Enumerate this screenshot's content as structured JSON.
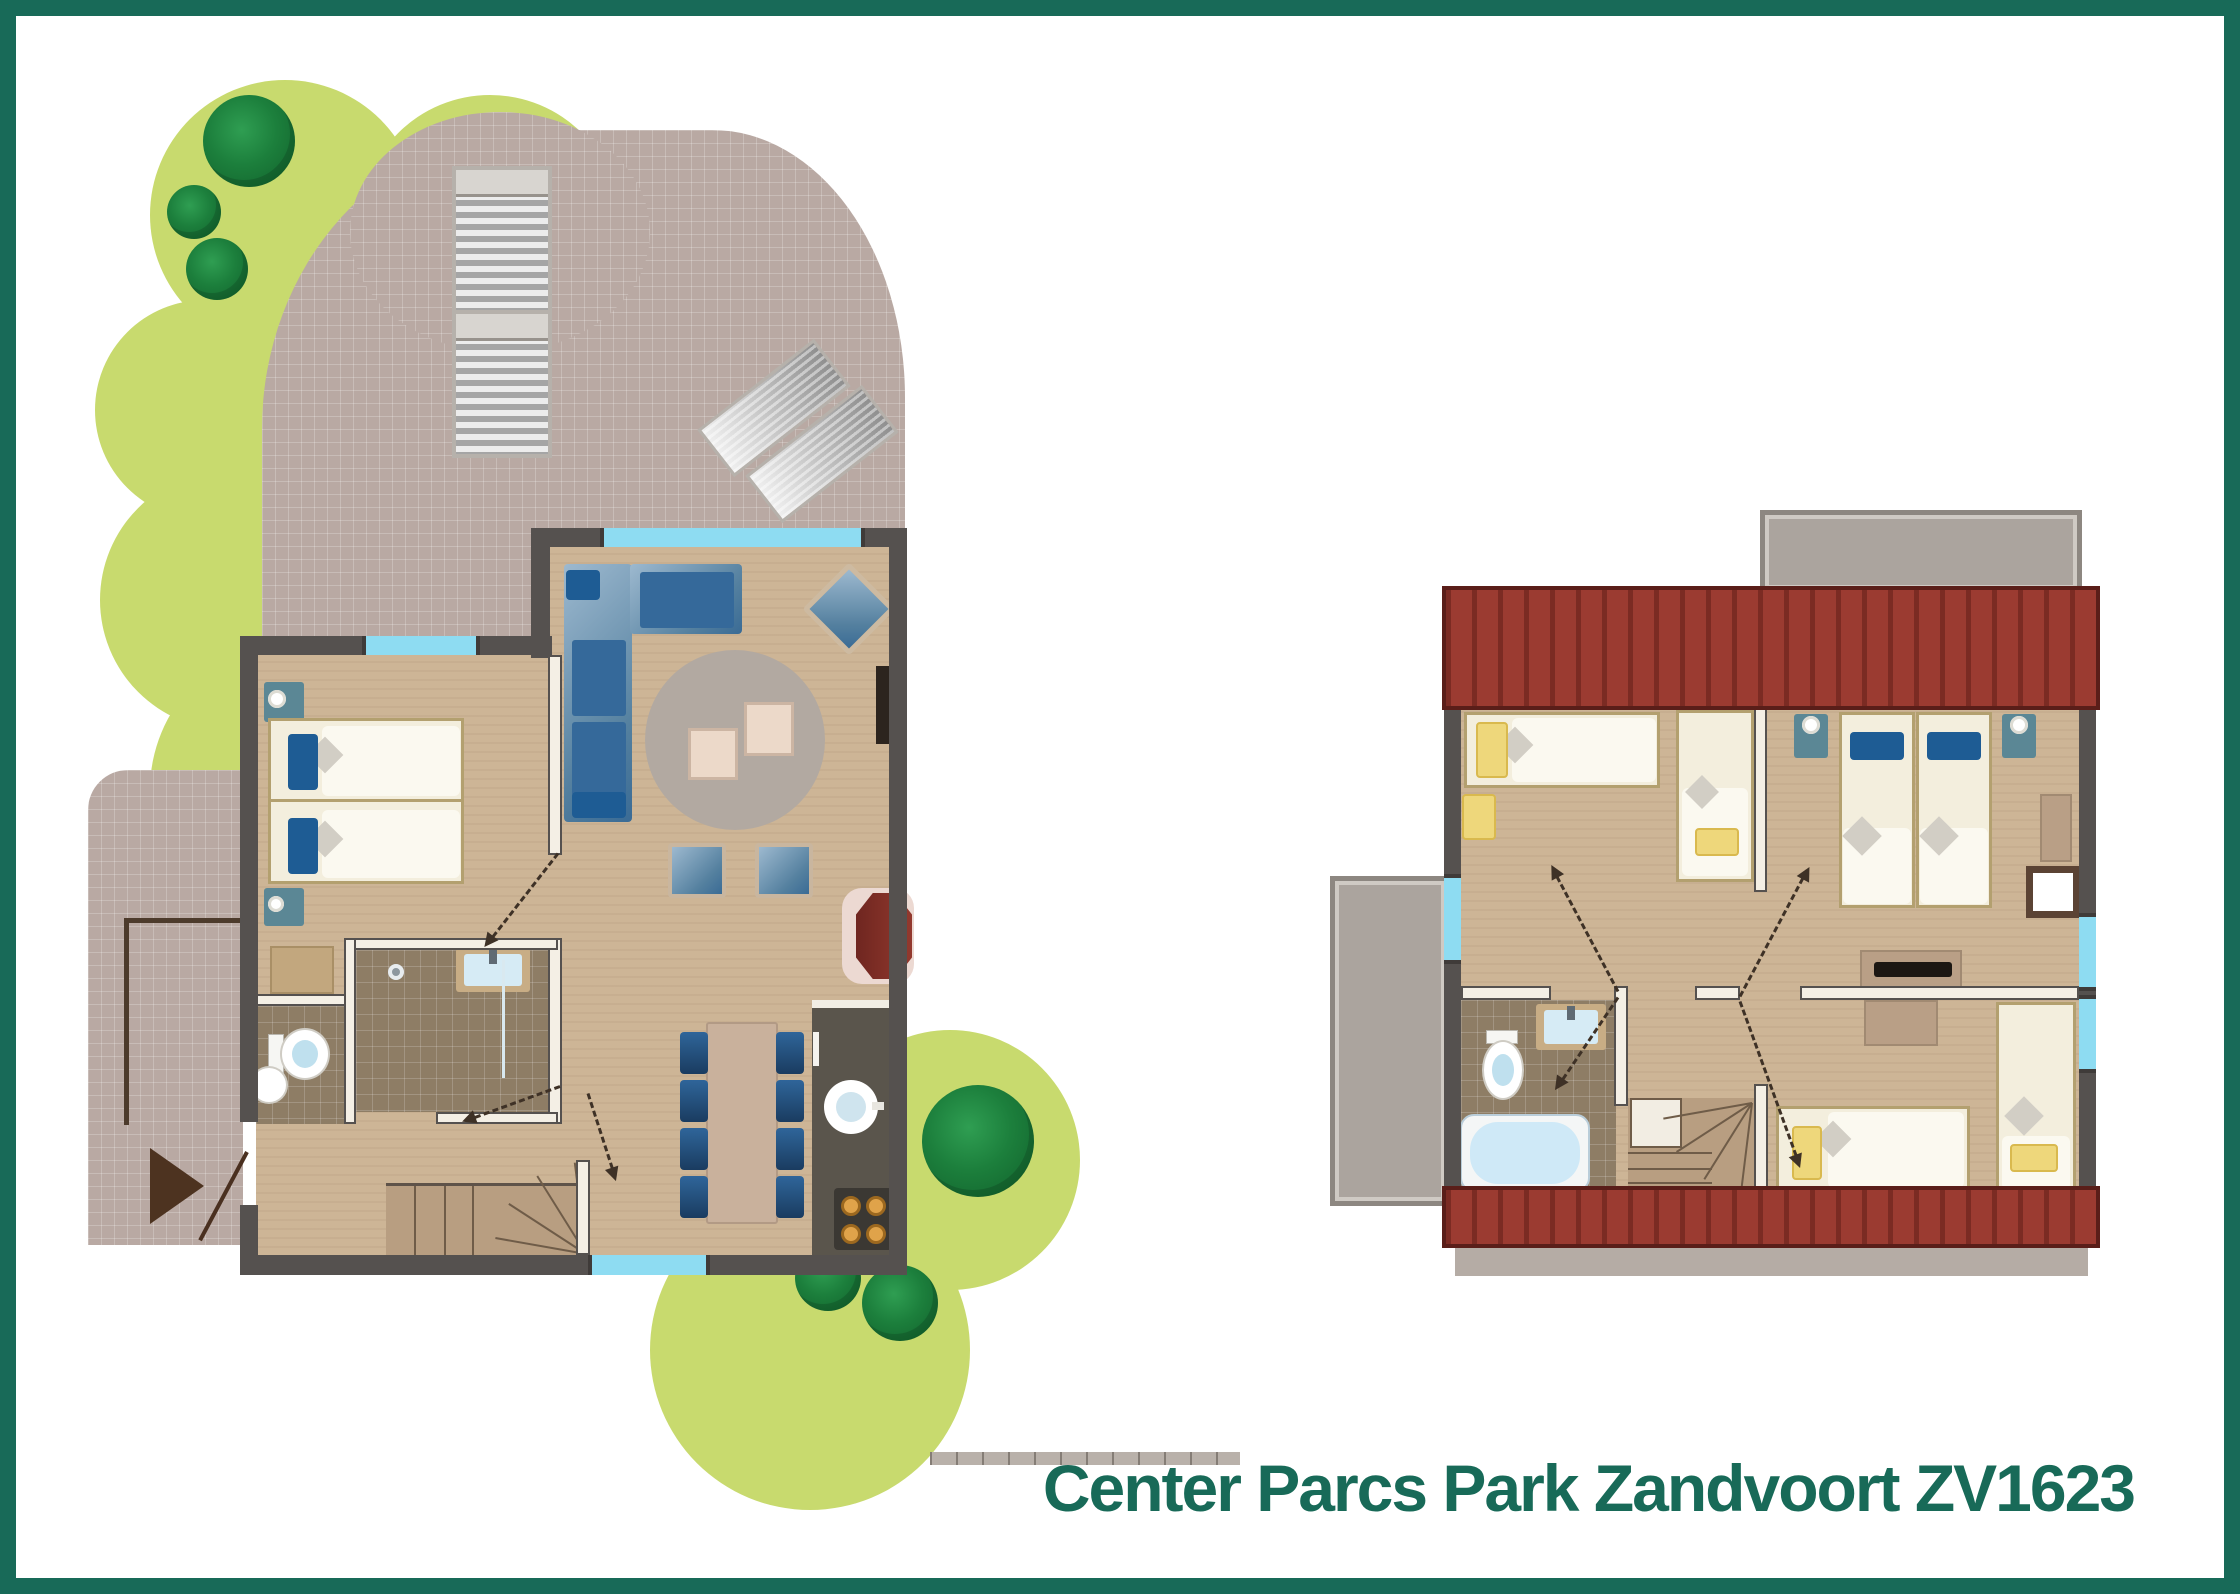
{
  "title": {
    "text": "Center Parcs Park Zandvoort ZV1623",
    "color": "#186a58"
  },
  "palette": {
    "frame": "#186a58",
    "background": "#ffffff",
    "lawn": "#c8da6e",
    "foliage": "#1c7f3c",
    "paving": "#b9a9a3",
    "wall": "#55514f",
    "window": "#8edcf2",
    "floor": "#cdb596",
    "tile": "#8e7d65",
    "interior_wall": "#f4efe5",
    "roof": "#9b3b31",
    "balcony": "#aba49e",
    "bed_linen": "#f3eedd",
    "pillow_blue": "#1e5c94",
    "pillow_yellow": "#eed77b",
    "sofa_blue": "#3f6f98",
    "kitchen_counter": "#5a554c",
    "hob_burner": "#d99b41",
    "fireplace": "#6f2620",
    "water": "#cfe9f7",
    "stairs": "#b89e81",
    "door_line": "#3e3126"
  },
  "plans": [
    {
      "id": "ground-floor",
      "outdoor": [
        "garden-lawn",
        "trees",
        "paved-terrace",
        "sun-loungers-x4",
        "porch",
        "entrance-arrow"
      ],
      "rooms": [
        "living-room",
        "bedroom",
        "shower-room",
        "wc",
        "kitchen",
        "dining-area",
        "hall-with-stairs"
      ],
      "furniture": [
        "corner-sofa",
        "armchair",
        "round-rug",
        "coffee-tables-x2",
        "ottomans-x2",
        "tv",
        "twin-beds",
        "nightstands-x2",
        "toilet",
        "corner-washbasin",
        "shower",
        "washbasin",
        "storage-cabinet",
        "kitchen-counter",
        "kitchen-sink",
        "hob",
        "oven",
        "fireplace",
        "dining-table",
        "dining-chairs-x8",
        "winder-staircase"
      ]
    },
    {
      "id": "upper-floor",
      "outdoor": [
        "roof-strip-top",
        "roof-strip-bottom",
        "balcony-top",
        "balcony-left"
      ],
      "rooms": [
        "bedroom-1",
        "bedroom-2",
        "bedroom-3",
        "bathroom",
        "landing-with-stairs"
      ],
      "furniture": [
        "single-beds-pair",
        "single-beds-x3",
        "nightstands-x2",
        "dressers-x3",
        "desk",
        "tv",
        "wall-niche",
        "bathtub",
        "toilet",
        "washbasin",
        "winder-staircase"
      ]
    }
  ]
}
